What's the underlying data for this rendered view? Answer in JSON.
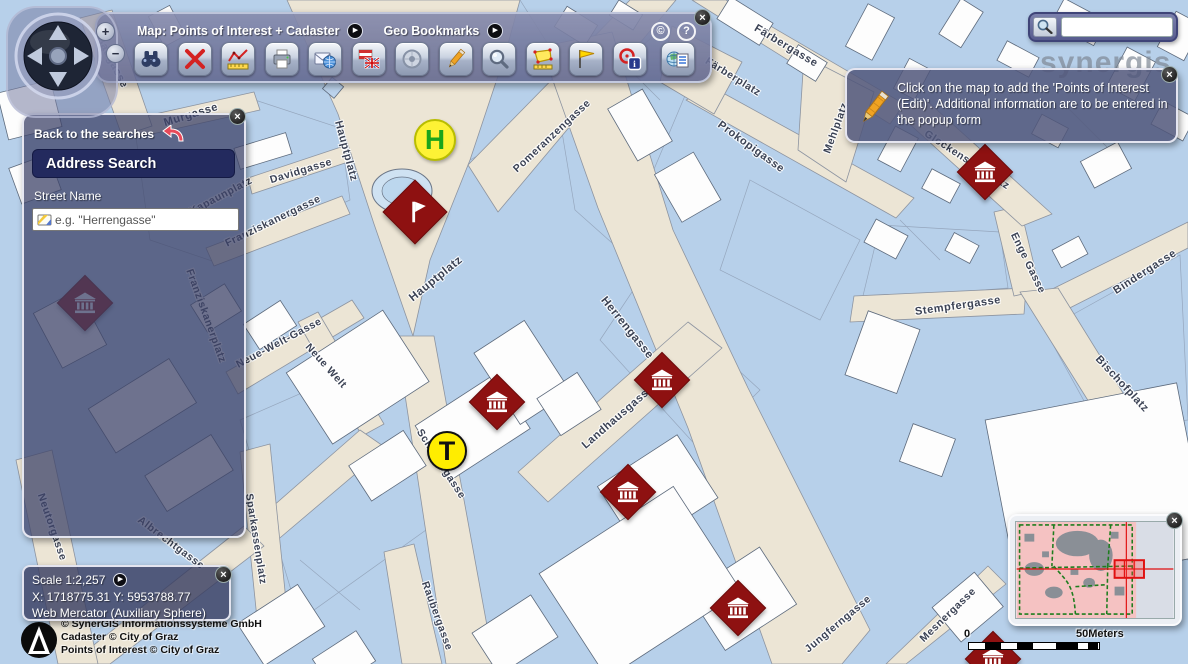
{
  "toolbar": {
    "map_title": "Map: Points of Interest + Cadaster",
    "bookmarks_title": "Geo Bookmarks",
    "copyright_symbol": "©",
    "help_symbol": "?",
    "tools": [
      "find",
      "clear-selection",
      "measure-line",
      "print",
      "send-map",
      "language-flags",
      "center-map",
      "edit",
      "zoom",
      "measure-area",
      "geo-bookmark-flag",
      "hotspot-info",
      "legend"
    ]
  },
  "compass": {
    "zoom_in": "+",
    "zoom_out": "−"
  },
  "search_panel": {
    "back_label": "Back to the searches",
    "title": "Address Search",
    "street_name_label": "Street Name",
    "input_value": "",
    "input_placeholder": "e.g. \"Herrengasse\""
  },
  "scale_panel": {
    "scale_label": "Scale 1:2,257",
    "coordinates": "X: 1718775.31 Y: 5953788.77",
    "projection": "Web Mercator (Auxiliary Sphere)"
  },
  "copyright": {
    "line1": "© SynerGIS Informationssysteme GmbH",
    "line2": "Cadaster © City of Graz",
    "line3": "Points of Interest © City of Graz"
  },
  "info_popup": {
    "message": "Click on the map to add the 'Points of Interest (Edit)'. Additional information are to be entered in the popup form"
  },
  "quick_search": {
    "value": "",
    "placeholder": ""
  },
  "scalebar": {
    "start": "0",
    "end": "50Meters"
  },
  "map": {
    "watermark": "synergis",
    "street_labels": [
      {
        "text": "Badgasse",
        "x": 112,
        "y": 62,
        "rot": 63,
        "size": 11
      },
      {
        "text": "Murgasse",
        "x": 191,
        "y": 115,
        "rot": -17,
        "size": 11
      },
      {
        "text": "Davidgasse",
        "x": 301,
        "y": 171,
        "rot": -17,
        "size": 10.5
      },
      {
        "text": "Franziskanergasse",
        "x": 273,
        "y": 221,
        "rot": -26,
        "size": 10.5
      },
      {
        "text": "Kapaunplatz",
        "x": 221,
        "y": 196,
        "rot": -28,
        "size": 10.5
      },
      {
        "text": "Hauptplatz",
        "x": 346,
        "y": 151,
        "rot": 75,
        "size": 11
      },
      {
        "text": "Hauptplatz",
        "x": 436,
        "y": 279,
        "rot": -39,
        "size": 11.5
      },
      {
        "text": "Pomeranzengasse",
        "x": 552,
        "y": 136,
        "rot": -43,
        "size": 10.5
      },
      {
        "text": "Färbergasse",
        "x": 786,
        "y": 46,
        "rot": 31,
        "size": 11
      },
      {
        "text": "Färberplatz",
        "x": 733,
        "y": 77,
        "rot": 32,
        "size": 10.5
      },
      {
        "text": "Prokopigasse",
        "x": 751,
        "y": 147,
        "rot": 36,
        "size": 11
      },
      {
        "text": "Mehlplatz",
        "x": 836,
        "y": 128,
        "rot": -70,
        "size": 10.5
      },
      {
        "text": "Glockenspielplatz",
        "x": 967,
        "y": 160,
        "rot": 33,
        "size": 10.5
      },
      {
        "text": "Herrengasse",
        "x": 627,
        "y": 328,
        "rot": 51,
        "size": 11.5
      },
      {
        "text": "Landhausgasse",
        "x": 618,
        "y": 417,
        "rot": -41,
        "size": 11
      },
      {
        "text": "Schmiedgasse",
        "x": 441,
        "y": 464,
        "rot": 57,
        "size": 10.5
      },
      {
        "text": "Sparkassenplatz",
        "x": 256,
        "y": 539,
        "rot": 81,
        "size": 10.5
      },
      {
        "text": "Raubergasse",
        "x": 437,
        "y": 616,
        "rot": 70,
        "size": 10.5
      },
      {
        "text": "Neue-Welt-Gasse",
        "x": 279,
        "y": 343,
        "rot": -28,
        "size": 10.5
      },
      {
        "text": "Neue Welt",
        "x": 326,
        "y": 366,
        "rot": 48,
        "size": 10.5
      },
      {
        "text": "Franziskanerplatz",
        "x": 206,
        "y": 316,
        "rot": 70,
        "size": 10.5
      },
      {
        "text": "Neutorgasse",
        "x": 52,
        "y": 527,
        "rot": 71,
        "size": 10.5
      },
      {
        "text": "Albrechtgasse",
        "x": 171,
        "y": 543,
        "rot": 37,
        "size": 10.5
      },
      {
        "text": "Stempfergasse",
        "x": 958,
        "y": 306,
        "rot": -8,
        "size": 11
      },
      {
        "text": "Enge Gasse",
        "x": 1028,
        "y": 263,
        "rot": 64,
        "size": 10.5
      },
      {
        "text": "Bindergasse",
        "x": 1145,
        "y": 272,
        "rot": -33,
        "size": 11
      },
      {
        "text": "Bischofplatz",
        "x": 1122,
        "y": 384,
        "rot": 47,
        "size": 11
      },
      {
        "text": "Jungferngasse",
        "x": 838,
        "y": 624,
        "rot": -40,
        "size": 10.5
      },
      {
        "text": "Mesnergasse",
        "x": 948,
        "y": 615,
        "rot": -44,
        "size": 10.5
      }
    ],
    "poi_markers": [
      {
        "x": 85,
        "y": 303,
        "icon": "museum"
      },
      {
        "x": 415,
        "y": 212,
        "icon": "flag"
      },
      {
        "x": 497,
        "y": 402,
        "icon": "museum"
      },
      {
        "x": 662,
        "y": 380,
        "icon": "museum"
      },
      {
        "x": 628,
        "y": 492,
        "icon": "museum"
      },
      {
        "x": 738,
        "y": 608,
        "icon": "museum"
      },
      {
        "x": 985,
        "y": 172,
        "icon": "museum"
      },
      {
        "x": 993,
        "y": 659,
        "icon": "museum"
      }
    ],
    "transit_markers": [
      {
        "x": 435,
        "y": 140,
        "letter": "H",
        "size": 42,
        "fg": "#1ba51b",
        "bg": "#fdf235",
        "border": "#b9bd00",
        "font": 28
      },
      {
        "x": 447,
        "y": 451,
        "letter": "T",
        "size": 40,
        "fg": "#111111",
        "bg": "#ffed00",
        "border": "#111111",
        "font": 27
      }
    ]
  },
  "icons": {
    "find": "binoculars",
    "clear-selection": "red-x",
    "measure-line": "chart-ruler",
    "print": "printer",
    "send-map": "envelope-globe",
    "language-flags": "austria-uk-flags",
    "center-map": "target",
    "edit": "pencil",
    "zoom": "magnifier",
    "measure-area": "polygon-ruler",
    "geo-bookmark-flag": "yellow-flag",
    "hotspot-info": "target-info",
    "legend": "globe-list",
    "back": "red-curved-arrow",
    "popup": "pencil",
    "quick_search": "magnifier",
    "poi": "museum-diamond",
    "poi_edit": "flag-diamond"
  },
  "colors": {
    "map_blue": "#b7d0ea",
    "street_beige": "#ece5d5",
    "building_white": "#fdfdfd",
    "panel_glass": "#484d72",
    "header_navy": "#232a5e",
    "poi_red": "#8e1111",
    "marker_yellow": "#ffed00",
    "h_green": "#1ba51b",
    "overview_pink": "#f5c2c2",
    "crosshair_red": "#e01010"
  }
}
